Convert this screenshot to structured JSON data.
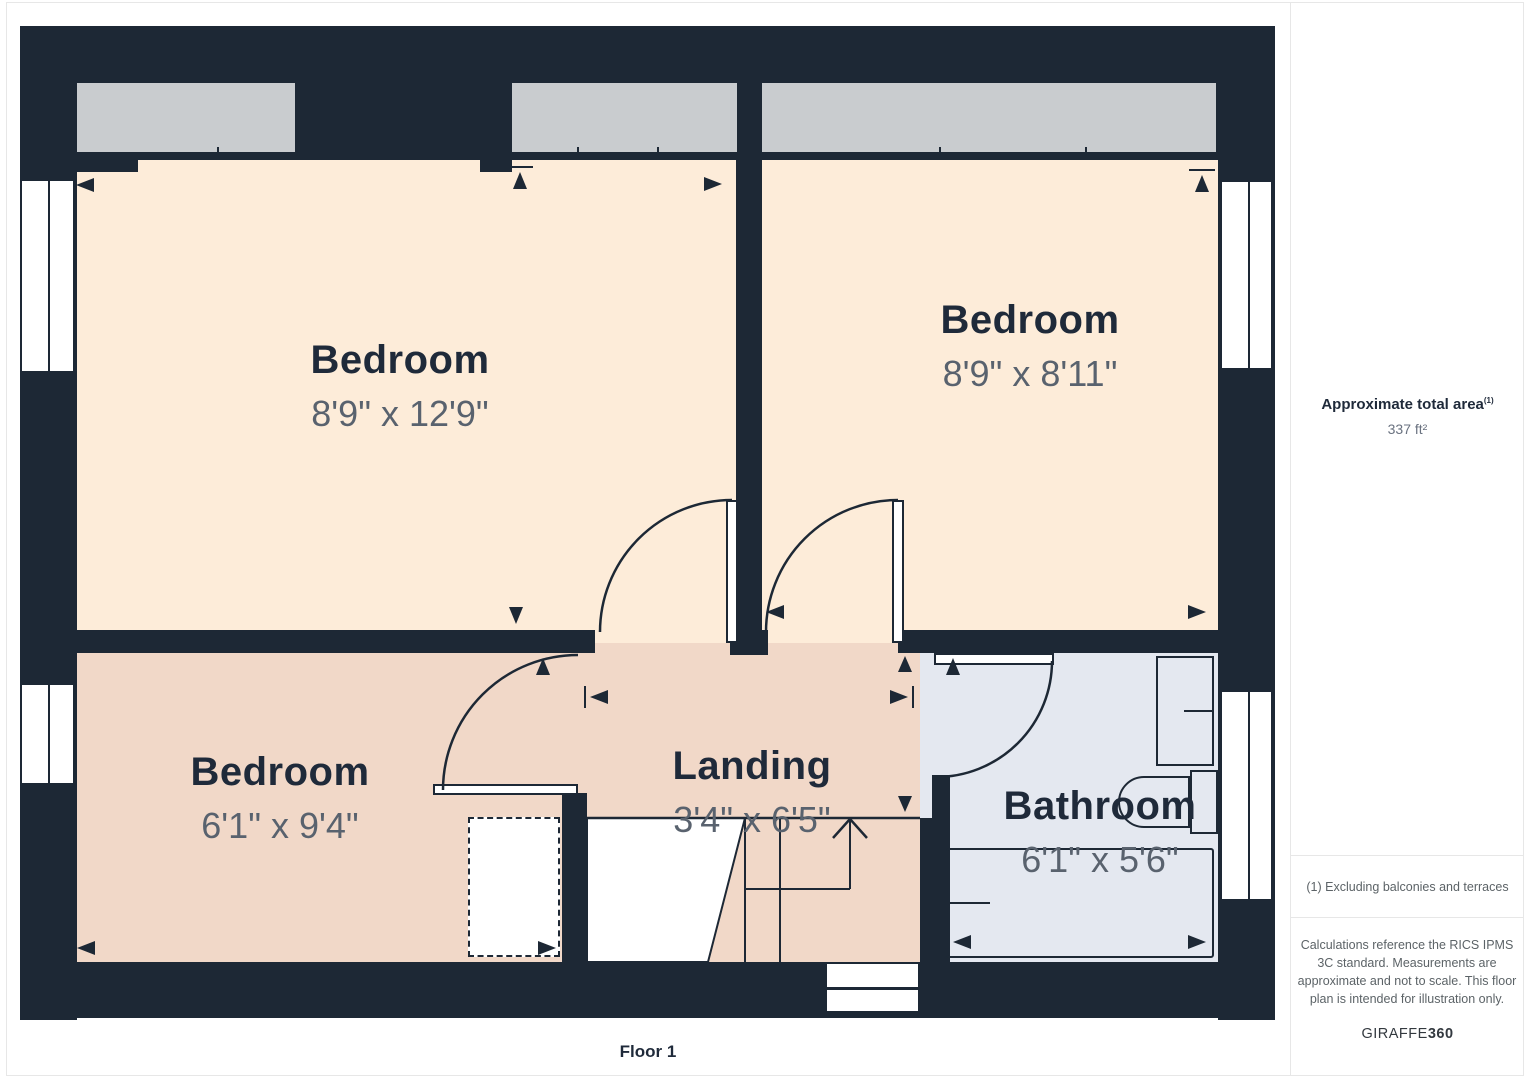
{
  "floor_label": "Floor 1",
  "rooms": [
    {
      "name": "Bedroom",
      "dims": "8'9\" x 12'9\""
    },
    {
      "name": "Bedroom",
      "dims": "8'9\" x 8'11\""
    },
    {
      "name": "Bedroom",
      "dims": "6'1\" x 9'4\""
    },
    {
      "name": "Landing",
      "dims": "3'4\" x 6'5\""
    },
    {
      "name": "Bathroom",
      "dims": "6'1\" x 5'6\""
    }
  ],
  "sidebar": {
    "area_title": "Approximate total area",
    "area_note_ref": "(1)",
    "area_value": "337 ft²",
    "footnote": "(1) Excluding balconies and terraces",
    "disclaimer": "Calculations reference the RICS IPMS 3C standard. Measurements are approximate and not to scale. This floor plan is intended for illustration only.",
    "brand": {
      "regular": "GIRAFFE",
      "bold": "360"
    }
  },
  "colors": {
    "wall": "#1d2835",
    "room-cream": "#fdecd9",
    "room-pink": "#f1d8c8",
    "room-blue": "#e4e8f0",
    "window-gray": "#c9cccf",
    "label": "#1f2a3a",
    "dims": "#59626e",
    "muted": "#5c6367",
    "border": "#e7e7e7"
  }
}
